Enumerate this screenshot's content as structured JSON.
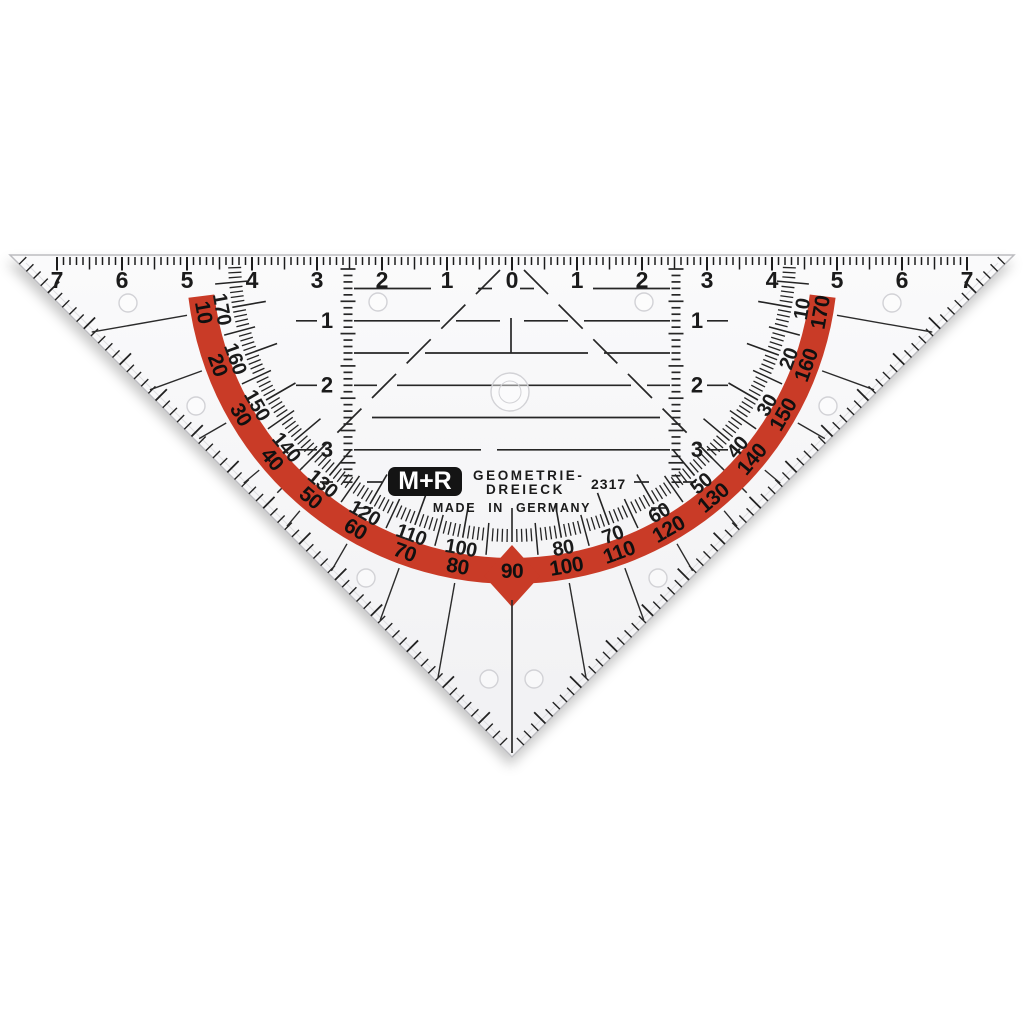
{
  "product": {
    "brand": "M+R",
    "name_line1": "GEOMETRIE-",
    "name_line2": "DREIECK",
    "model": "2317",
    "origin": "MADE IN GERMANY"
  },
  "hypotenuse_ruler": {
    "cm_labels": [
      "7",
      "6",
      "5",
      "4",
      "3",
      "2",
      "1",
      "0",
      "1",
      "2",
      "3",
      "4",
      "5",
      "6",
      "7"
    ]
  },
  "protractor": {
    "band_scale_deg": [
      10,
      20,
      30,
      40,
      50,
      60,
      70,
      80,
      90,
      100,
      110,
      120,
      130,
      140,
      150,
      160,
      170
    ],
    "inner_scale_deg": [
      10,
      20,
      30,
      40,
      50,
      60,
      70,
      80,
      100,
      110,
      120,
      130,
      140,
      150,
      160,
      170
    ],
    "apex_label": "90"
  },
  "parallel_guides": {
    "labels": [
      "1",
      "2",
      "3"
    ]
  },
  "colors": {
    "band_red": "#c93b27",
    "ink": "#1b1b1b",
    "line": "#262626",
    "plastic": "#f6f6f7",
    "plastic_edge": "#bcbcc0",
    "bevel": "#e0e0e3",
    "dot_stroke": "#d2d2d6",
    "logo_bg": "#141414",
    "logo_fg": "#ffffff"
  }
}
